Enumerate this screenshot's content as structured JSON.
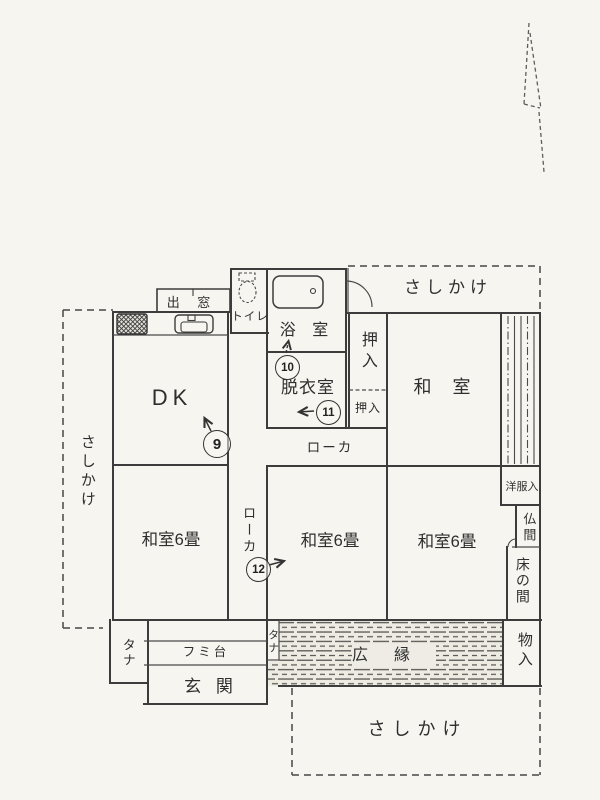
{
  "page": {
    "background": "#f7f5f0",
    "ink": "#3c3c3c"
  },
  "labels": {
    "sashikake_top": "さしかけ",
    "sashikake_left": "さしかけ",
    "sashikake_bottom": "さしかけ",
    "bay_window": "出 窓",
    "toilet": "トイレ",
    "bathroom": "浴 室",
    "dressing_room": "脱衣室",
    "closet_upper": "押入",
    "closet_lower": "押入",
    "japanese_room_ne": "和 室",
    "corridor_horizontal": "ローカ",
    "corridor_vertical": "ローカ",
    "japanese_room6_left": "和室6畳",
    "japanese_room6_middle": "和室6畳",
    "japanese_room6_right": "和室6畳",
    "clothes_closet": "洋服入",
    "butsuma": "仏間",
    "tokonoma": "床の間",
    "storage": "物入",
    "veranda": "広縁",
    "shelf_left": "タナ",
    "shelf_right": "タナ",
    "step_platform": "フミ台",
    "entrance": "玄 関",
    "dk": "DK"
  },
  "markers": {
    "m9": "9",
    "m10": "10",
    "m11": "11",
    "m12": "12"
  }
}
